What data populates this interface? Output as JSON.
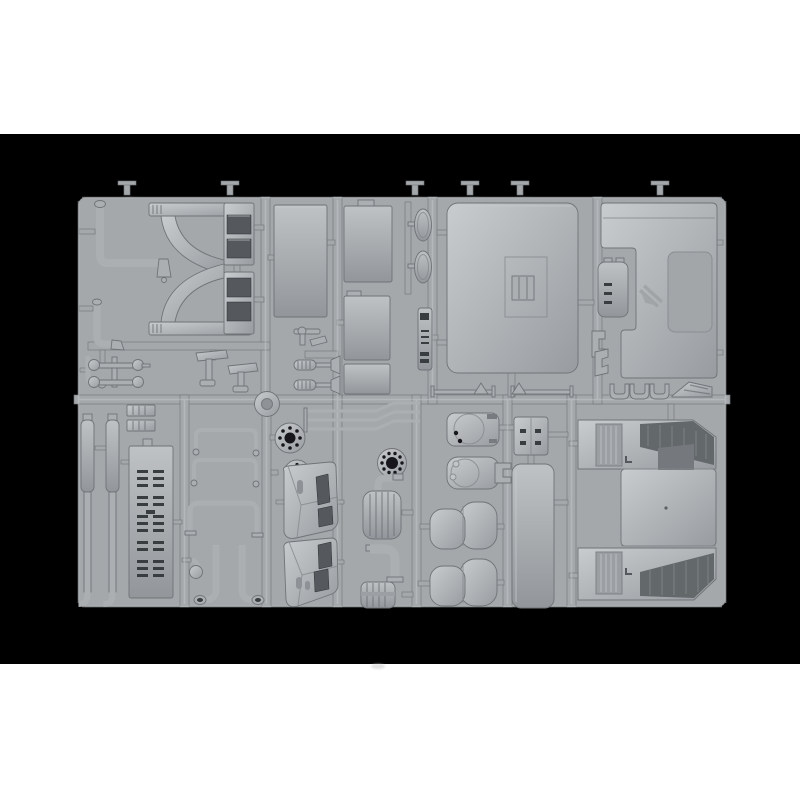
{
  "photo": {
    "subject": "injection-molded model kit sprue of grey styrene truck parts on black background"
  },
  "palette": {
    "page": "#ffffff",
    "bg": "#000000",
    "plastic": "#abafb2",
    "plastic-hi": "#c9ccce",
    "plastic-lo": "#84888c",
    "runner": "#a4a8ab",
    "edge": "#6f7377",
    "inset": "#54585c",
    "slot": "#393c40",
    "hole": "#17181a",
    "detail": "#8e9296"
  },
  "parts": {
    "pipe_upper": "bent exhaust pipe with down-spout",
    "pipe_lower": "short bent filler pipe",
    "hook_fitting": "small hooked fitting",
    "arch_upper": "wheel arch fender half (upper)",
    "arch_lower": "wheel arch fender half (lower)",
    "rod_links": "linkage rods with disc ends",
    "pedal_brackets": "pedal / lever brackets",
    "side_panel": "tall flat side panel",
    "valve_fittings": "small valve fittings",
    "shock_absorbers": "coil-spring shock absorbers",
    "panel_a": "flat panel (upper)",
    "panel_b": "flat panel (middle)",
    "panel_c": "flat panel (lower)",
    "mirror_left": "rear-view mirror housing",
    "mirror_right": "rear-view mirror housing",
    "ribbed_strip": "ribbed trim strip",
    "roof": "cab roof panel with sunroof recess",
    "wiper_left": "windscreen wiper arm",
    "wiper_right": "windscreen wiper arm",
    "rear_wall": "cab rear wall panel with embossed logo",
    "hatch_door": "small hinged hatch door",
    "step_clips": "stepped mounting clips",
    "u_channels": "U-channel brackets",
    "tread_wedge": "tread-plate wedge",
    "exhaust_stack_1": "vertical exhaust stack",
    "exhaust_stack_2": "vertical exhaust stack",
    "ribbed_blocks": "small ribbed blocks",
    "deck_plate": "perforated chassis deck plate",
    "grab_handle_1": "grab handle rail",
    "grab_handle_2": "grab handle rail",
    "roll_bar": "U-shaped light bar",
    "j_pipe_1": "J-curved intake pipe",
    "j_pipe_2": "J-curved intake pipe",
    "ball_elbow": "ball-end elbow fitting",
    "hub_disc": "hub disc",
    "flange_large": "bolted wheel flange",
    "flange_small": "bolted wheel flange (small)",
    "dash_upper": "cab interior corner panel (upper)",
    "dash_lower": "cab interior corner panel (lower)",
    "brake_lines": "bent brake lines",
    "bolt_ring": "bolt-hole ring flange",
    "muffler": "ribbed muffler barrel",
    "elbow_pipe": "thick elbow pipe",
    "ribbed_drum": "ribbed drum canister",
    "tank_cover_1": "tank end cover plate",
    "tank_cover_2": "tank end cover with bosses",
    "seat_1": "suspension seat",
    "seat_2": "suspension seat",
    "equipment_box": "equipment box",
    "bunk_panel": "sleeper bunk panel",
    "cab_floor": "cab floor with engine tunnel and tread steps"
  }
}
